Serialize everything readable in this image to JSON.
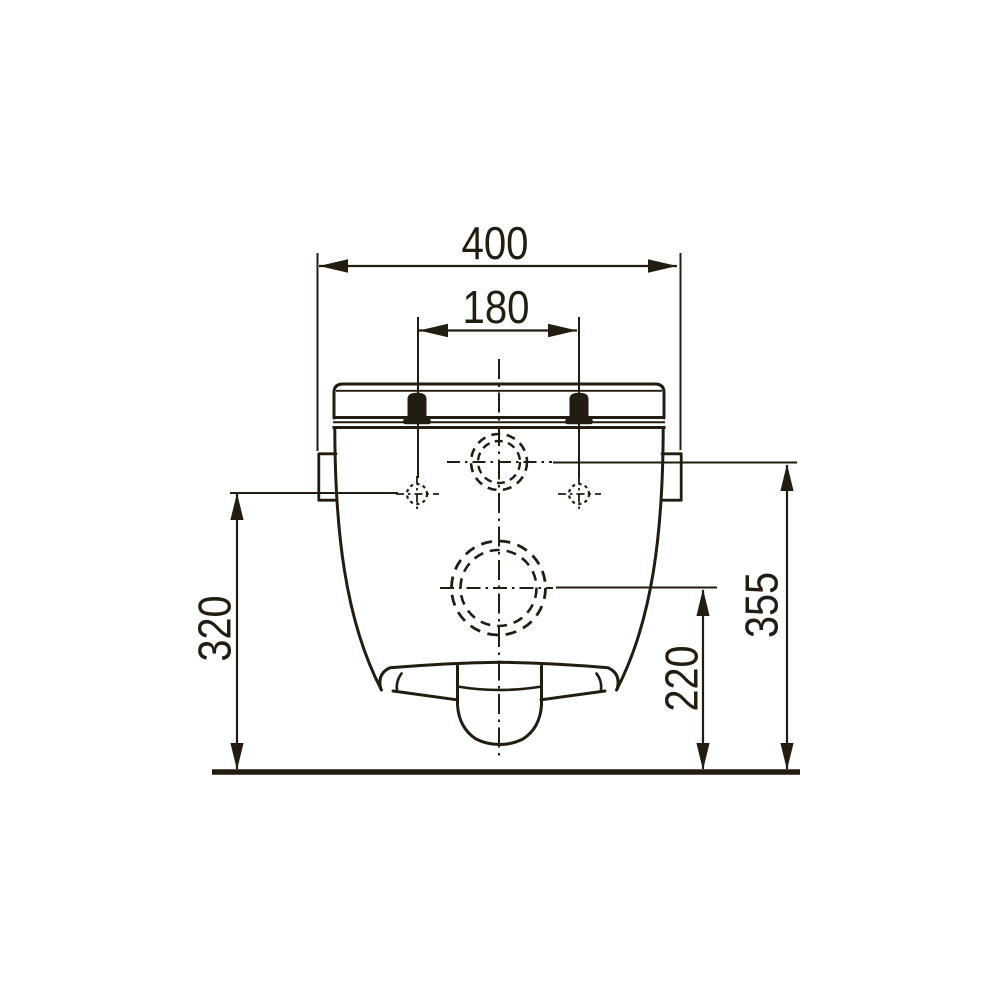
{
  "colors": {
    "ink": "#231c10",
    "background": "#ffffff"
  },
  "dimensions": {
    "overall_width": "400",
    "bolt_spacing": "180",
    "left_height": "320",
    "right_height": "355",
    "outlet_center_height": "220"
  }
}
